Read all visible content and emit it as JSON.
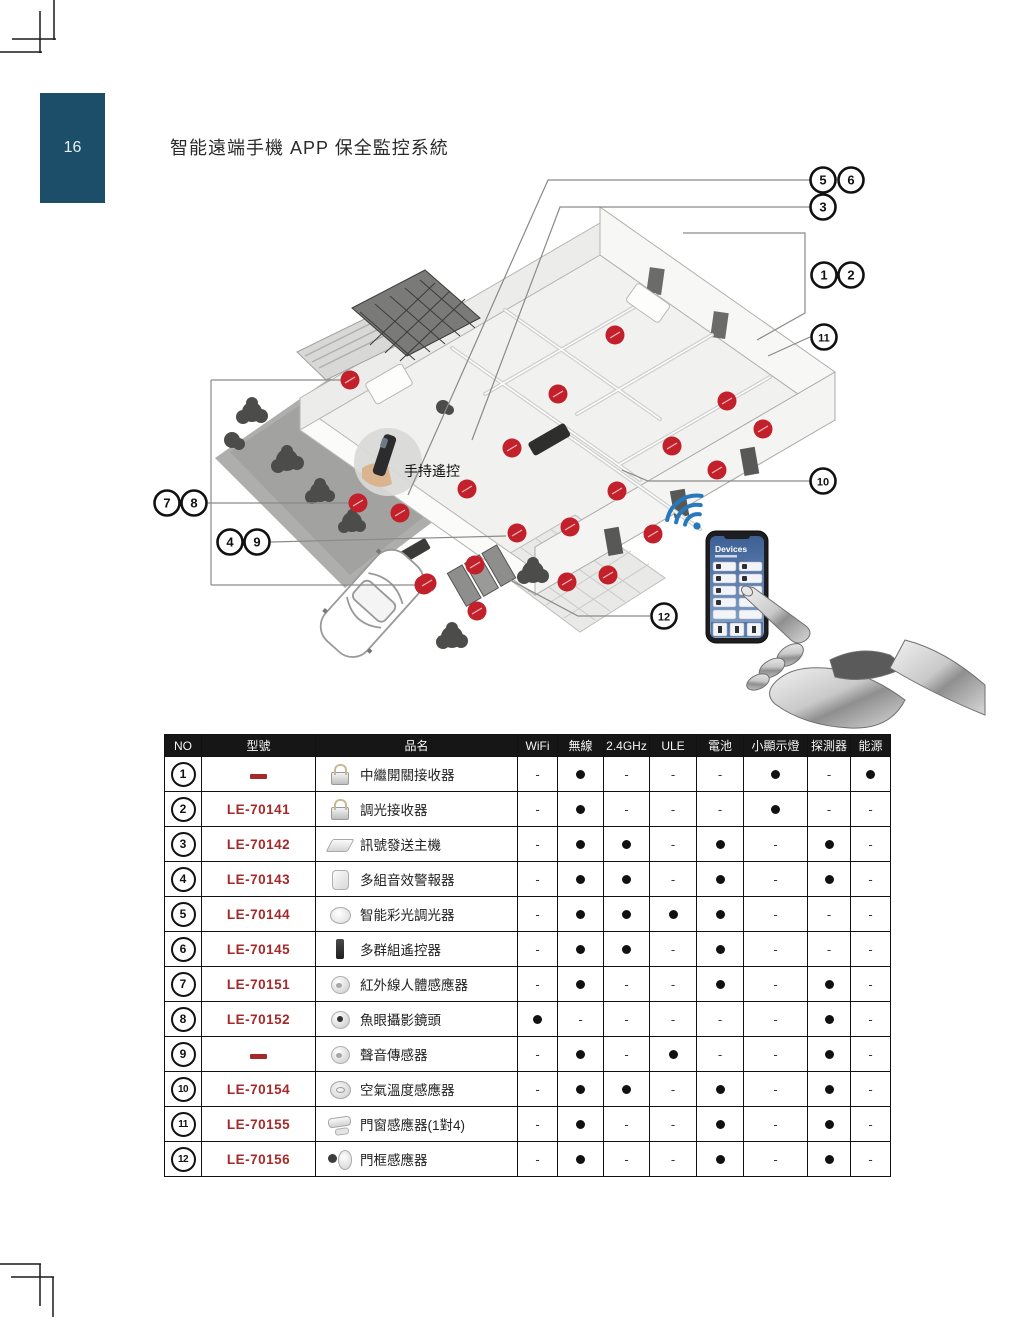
{
  "page": {
    "number": "16",
    "title": "智能遠端手機 APP 保全監控系統"
  },
  "illustration": {
    "remote_label": "手持遙控",
    "phone": {
      "header": "Devices"
    },
    "colors": {
      "dot_red": "#c2202a",
      "leader_line": "#8a8a8a",
      "callout_ring": "#111111",
      "wifi_blue": "#2878be",
      "pagebox_blue": "#1d4e69",
      "model_red": "#a32a28"
    },
    "callouts": [
      {
        "n": "5",
        "x": 823,
        "y": 180
      },
      {
        "n": "6",
        "x": 851,
        "y": 180
      },
      {
        "n": "3",
        "x": 823,
        "y": 207
      },
      {
        "n": "1",
        "x": 824,
        "y": 275
      },
      {
        "n": "2",
        "x": 851,
        "y": 275
      },
      {
        "n": "11",
        "x": 824,
        "y": 337
      },
      {
        "n": "10",
        "x": 823,
        "y": 481
      },
      {
        "n": "7",
        "x": 167,
        "y": 503
      },
      {
        "n": "8",
        "x": 194,
        "y": 503
      },
      {
        "n": "4",
        "x": 230,
        "y": 542
      },
      {
        "n": "9",
        "x": 257,
        "y": 542
      },
      {
        "n": "12",
        "x": 664,
        "y": 616
      }
    ],
    "leader_lines": [
      [
        [
          810,
          180
        ],
        [
          548,
          180
        ],
        [
          408,
          495
        ]
      ],
      [
        [
          810,
          207
        ],
        [
          560,
          207
        ],
        [
          472,
          440
        ]
      ],
      [
        [
          683,
          233
        ],
        [
          805,
          233
        ],
        [
          805,
          313
        ],
        [
          757,
          340
        ]
      ],
      [
        [
          810,
          337
        ],
        [
          768,
          356
        ]
      ],
      [
        [
          810,
          481
        ],
        [
          648,
          481
        ],
        [
          622,
          470
        ]
      ],
      [
        [
          211,
          380
        ],
        [
          211,
          585
        ]
      ],
      [
        [
          211,
          380
        ],
        [
          350,
          380
        ]
      ],
      [
        [
          208,
          503
        ],
        [
          358,
          503
        ]
      ],
      [
        [
          211,
          585
        ],
        [
          424,
          585
        ]
      ],
      [
        [
          271,
          542
        ],
        [
          506,
          536
        ]
      ],
      [
        [
          650,
          616
        ],
        [
          578,
          616
        ],
        [
          497,
          573
        ]
      ]
    ],
    "dots": [
      [
        615,
        335
      ],
      [
        558,
        394
      ],
      [
        727,
        401
      ],
      [
        763,
        429
      ],
      [
        672,
        446
      ],
      [
        512,
        448
      ],
      [
        717,
        470
      ],
      [
        350,
        380
      ],
      [
        467,
        489
      ],
      [
        400,
        513
      ],
      [
        617,
        491
      ],
      [
        570,
        527
      ],
      [
        653,
        534
      ],
      [
        608,
        575
      ],
      [
        567,
        582
      ],
      [
        358,
        503
      ],
      [
        477,
        611
      ],
      [
        424,
        585
      ],
      [
        517,
        533
      ],
      [
        475,
        565
      ],
      [
        427,
        583
      ]
    ]
  },
  "table": {
    "headers": [
      "NO",
      "型號",
      "品名",
      "WiFi",
      "無線",
      "2.4GHz",
      "ULE",
      "電池",
      "小顯示燈",
      "探測器",
      "能源"
    ],
    "rows": [
      {
        "no": "1",
        "model": "",
        "name": "中繼開關接收器",
        "thumb": "lock",
        "flags": [
          0,
          1,
          0,
          0,
          0,
          1,
          0,
          1
        ]
      },
      {
        "no": "2",
        "model": "LE-70141",
        "name": "調光接收器",
        "thumb": "lock",
        "flags": [
          0,
          1,
          0,
          0,
          0,
          1,
          0,
          0
        ]
      },
      {
        "no": "3",
        "model": "LE-70142",
        "name": "訊號發送主機",
        "thumb": "hub",
        "flags": [
          0,
          1,
          1,
          0,
          1,
          0,
          1,
          0
        ]
      },
      {
        "no": "4",
        "model": "LE-70143",
        "name": "多組音效警報器",
        "thumb": "siren",
        "flags": [
          0,
          1,
          1,
          0,
          1,
          0,
          1,
          0
        ]
      },
      {
        "no": "5",
        "model": "LE-70144",
        "name": "智能彩光調光器",
        "thumb": "disc",
        "flags": [
          0,
          1,
          1,
          1,
          1,
          0,
          0,
          0
        ]
      },
      {
        "no": "6",
        "model": "LE-70145",
        "name": "多群組遙控器",
        "thumb": "remote",
        "flags": [
          0,
          1,
          1,
          0,
          1,
          0,
          0,
          0
        ]
      },
      {
        "no": "7",
        "model": "LE-70151",
        "name": "紅外線人體感應器",
        "thumb": "dome",
        "flags": [
          0,
          1,
          0,
          0,
          1,
          0,
          1,
          0
        ]
      },
      {
        "no": "8",
        "model": "LE-70152",
        "name": "魚眼攝影鏡頭",
        "thumb": "cam",
        "flags": [
          1,
          0,
          0,
          0,
          0,
          0,
          1,
          0
        ]
      },
      {
        "no": "9",
        "model": "",
        "name": "聲音傳感器",
        "thumb": "dome",
        "flags": [
          0,
          1,
          0,
          1,
          0,
          0,
          1,
          0
        ]
      },
      {
        "no": "10",
        "model": "LE-70154",
        "name": "空氣溫度感應器",
        "thumb": "disc2",
        "flags": [
          0,
          1,
          1,
          0,
          1,
          0,
          1,
          0
        ]
      },
      {
        "no": "11",
        "model": "LE-70155",
        "name": "門窗感應器(1對4)",
        "thumb": "bar",
        "flags": [
          0,
          1,
          0,
          0,
          1,
          0,
          1,
          0
        ]
      },
      {
        "no": "12",
        "model": "LE-70156",
        "name": "門框感應器",
        "thumb": "pair",
        "flags": [
          0,
          1,
          0,
          0,
          1,
          0,
          1,
          0
        ]
      }
    ]
  }
}
